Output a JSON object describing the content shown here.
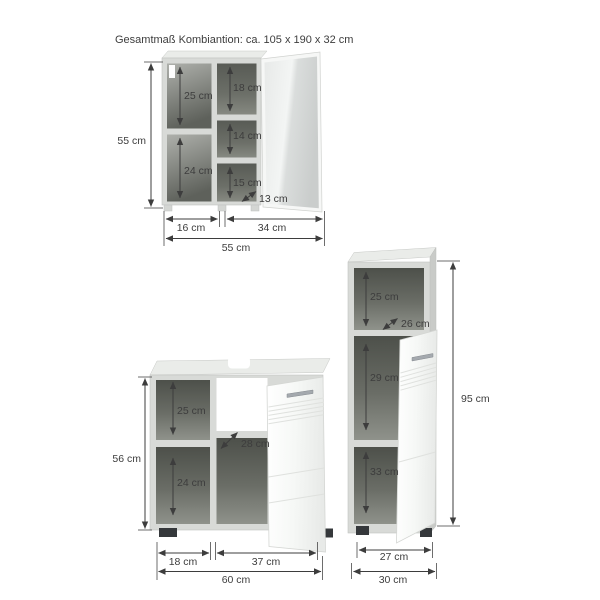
{
  "title": "Gesamtmaß Kombiantion: ca. 105 x 190 x 32 cm",
  "colors": {
    "background": "#ffffff",
    "carcass": "#d8dad7",
    "interior_dark": "#52554f",
    "door_white": "#f5f7f5",
    "handle_metal": "#a4a9ae",
    "dimension_ink": "#3d3d3d"
  },
  "mirror_cabinet": {
    "height_total": "55 cm",
    "width_total": "55 cm",
    "width_left_section": "16 cm",
    "width_right_section": "34 cm",
    "compartment_left_top": "25 cm",
    "compartment_left_bottom": "24 cm",
    "compartment_right_top": "18 cm",
    "compartment_right_middle": "14 cm",
    "compartment_right_bottom": "15 cm",
    "depth_inner": "13 cm"
  },
  "vanity_cabinet": {
    "height_total": "56 cm",
    "width_total": "60 cm",
    "width_left_section": "18 cm",
    "width_right_section": "37 cm",
    "compartment_left_top": "25 cm",
    "compartment_left_bottom": "24 cm",
    "depth_inner": "28 cm"
  },
  "tall_cabinet": {
    "height_total": "95 cm",
    "width_total": "30 cm",
    "width_inner": "27 cm",
    "compartment_top": "25 cm",
    "compartment_middle": "29 cm",
    "compartment_bottom": "33 cm",
    "depth_inner": "26 cm"
  }
}
